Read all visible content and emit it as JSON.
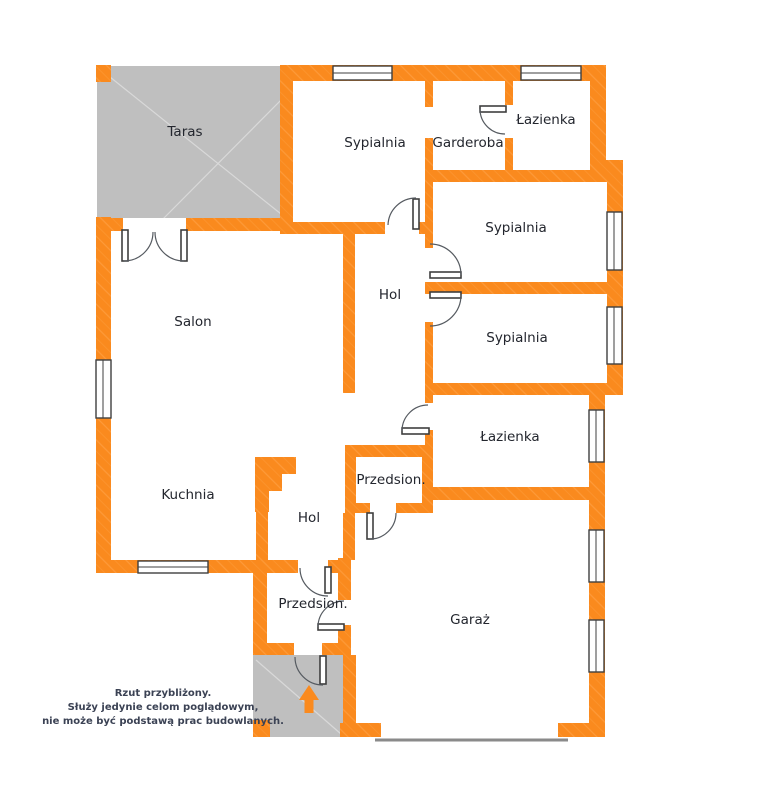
{
  "meta": {
    "type": "floor-plan",
    "disclaimer_lines": [
      "Rzut przybliżony.",
      "Służy jedynie celom poglądowym,",
      "nie może być podstawą prac budowlanych."
    ]
  },
  "rooms": [
    {
      "id": "taras",
      "label": "Taras"
    },
    {
      "id": "sypialnia-top",
      "label": "Sypialnia"
    },
    {
      "id": "garderoba",
      "label": "Garderoba"
    },
    {
      "id": "lazienka-top",
      "label": "Łazienka"
    },
    {
      "id": "sypialnia-mid",
      "label": "Sypialnia"
    },
    {
      "id": "hol-upper",
      "label": "Hol"
    },
    {
      "id": "salon",
      "label": "Salon"
    },
    {
      "id": "sypialnia-low",
      "label": "Sypialnia"
    },
    {
      "id": "lazienka-lower",
      "label": "Łazienka"
    },
    {
      "id": "przedsionek-upper",
      "label": "Przedsion."
    },
    {
      "id": "kuchnia",
      "label": "Kuchnia"
    },
    {
      "id": "hol-lower",
      "label": "Hol"
    },
    {
      "id": "przedsionek-lower",
      "label": "Przedsion."
    },
    {
      "id": "garaz",
      "label": "Garaż"
    }
  ],
  "icons": {
    "entrance_arrow": "up-arrow"
  },
  "colors": {
    "wall": "#fa8a1e",
    "wall_hatch": "#ffa850",
    "terrace": "#bfbfbf",
    "frame": "#3f3f3f",
    "door_arc": "#555a60",
    "label": "#23262e",
    "disclaimer": "#3b4254",
    "threshold": "#8a8a8a",
    "bg": "#ffffff"
  }
}
